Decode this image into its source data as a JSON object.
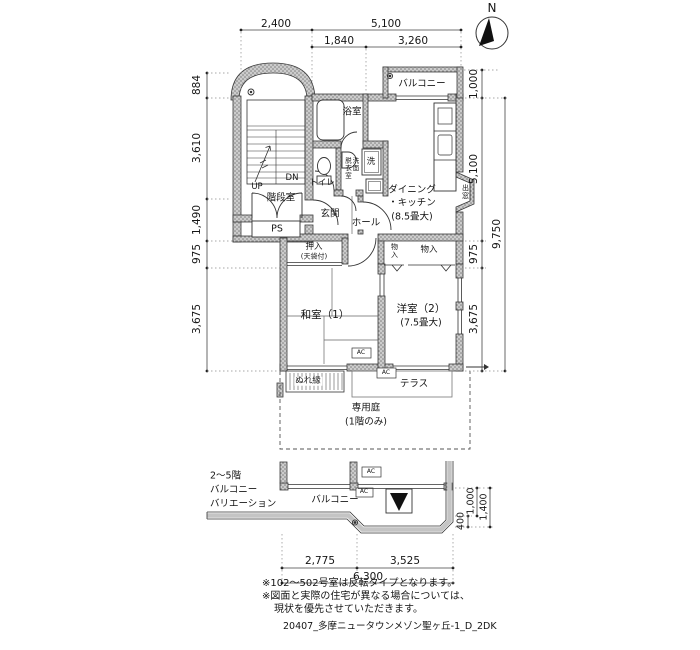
{
  "compass": {
    "north_label": "N"
  },
  "dims": {
    "top_row1": [
      "2,400",
      "5,100"
    ],
    "top_row2": [
      "1,840",
      "3,260"
    ],
    "left": [
      "884",
      "3,610",
      "1,490",
      "975",
      "3,675"
    ],
    "right_inner": [
      "1,000",
      "5,100",
      "975",
      "3,675"
    ],
    "right_outer": "9,750",
    "bottom_row1": [
      "2,775",
      "3,525"
    ],
    "bottom_total": "6,300",
    "balcony_right": [
      "400",
      "1,000",
      "1,400"
    ]
  },
  "rooms": {
    "balcony_top": "バルコニー",
    "bath": "浴室",
    "senmen": "洗面",
    "datsui": "脱衣室",
    "washer": "洗",
    "toilet": "トイレ",
    "entrance": "玄関",
    "hall": "ホール",
    "stairs_up": "UP",
    "stairs_dn": "DN",
    "stairwell": "階段室",
    "ps": "PS",
    "dk_line1": "ダイニング",
    "dk_line2": "・キッチン",
    "dk_line3": "(8.5畳大)",
    "bay_window": "出窓",
    "oshiire": "押入",
    "oshiire_sub": "(天袋付)",
    "closet_small": "物入",
    "closet_wide": "物入",
    "washitsu": "和室（1）",
    "yoshitsu_line1": "洋室（2）",
    "yoshitsu_line2": "(7.5畳大)",
    "nureen": "ぬれ縁",
    "terrace": "テラス",
    "garden_line1": "専用庭",
    "garden_line2": "(1階のみ)",
    "balcony_bottom": "バルコニー",
    "ac": "AC"
  },
  "variation_label": [
    "2〜5階",
    "バルコニー",
    "バリエーション"
  ],
  "notes": [
    "※102〜502号室は反転タイプとなります。",
    "※図面と実際の住宅が異なる場合については、",
    "現状を優先させていただきます。"
  ],
  "footer": "20407_多摩ニュータウンメゾン聖ヶ丘-1_D_2DK"
}
